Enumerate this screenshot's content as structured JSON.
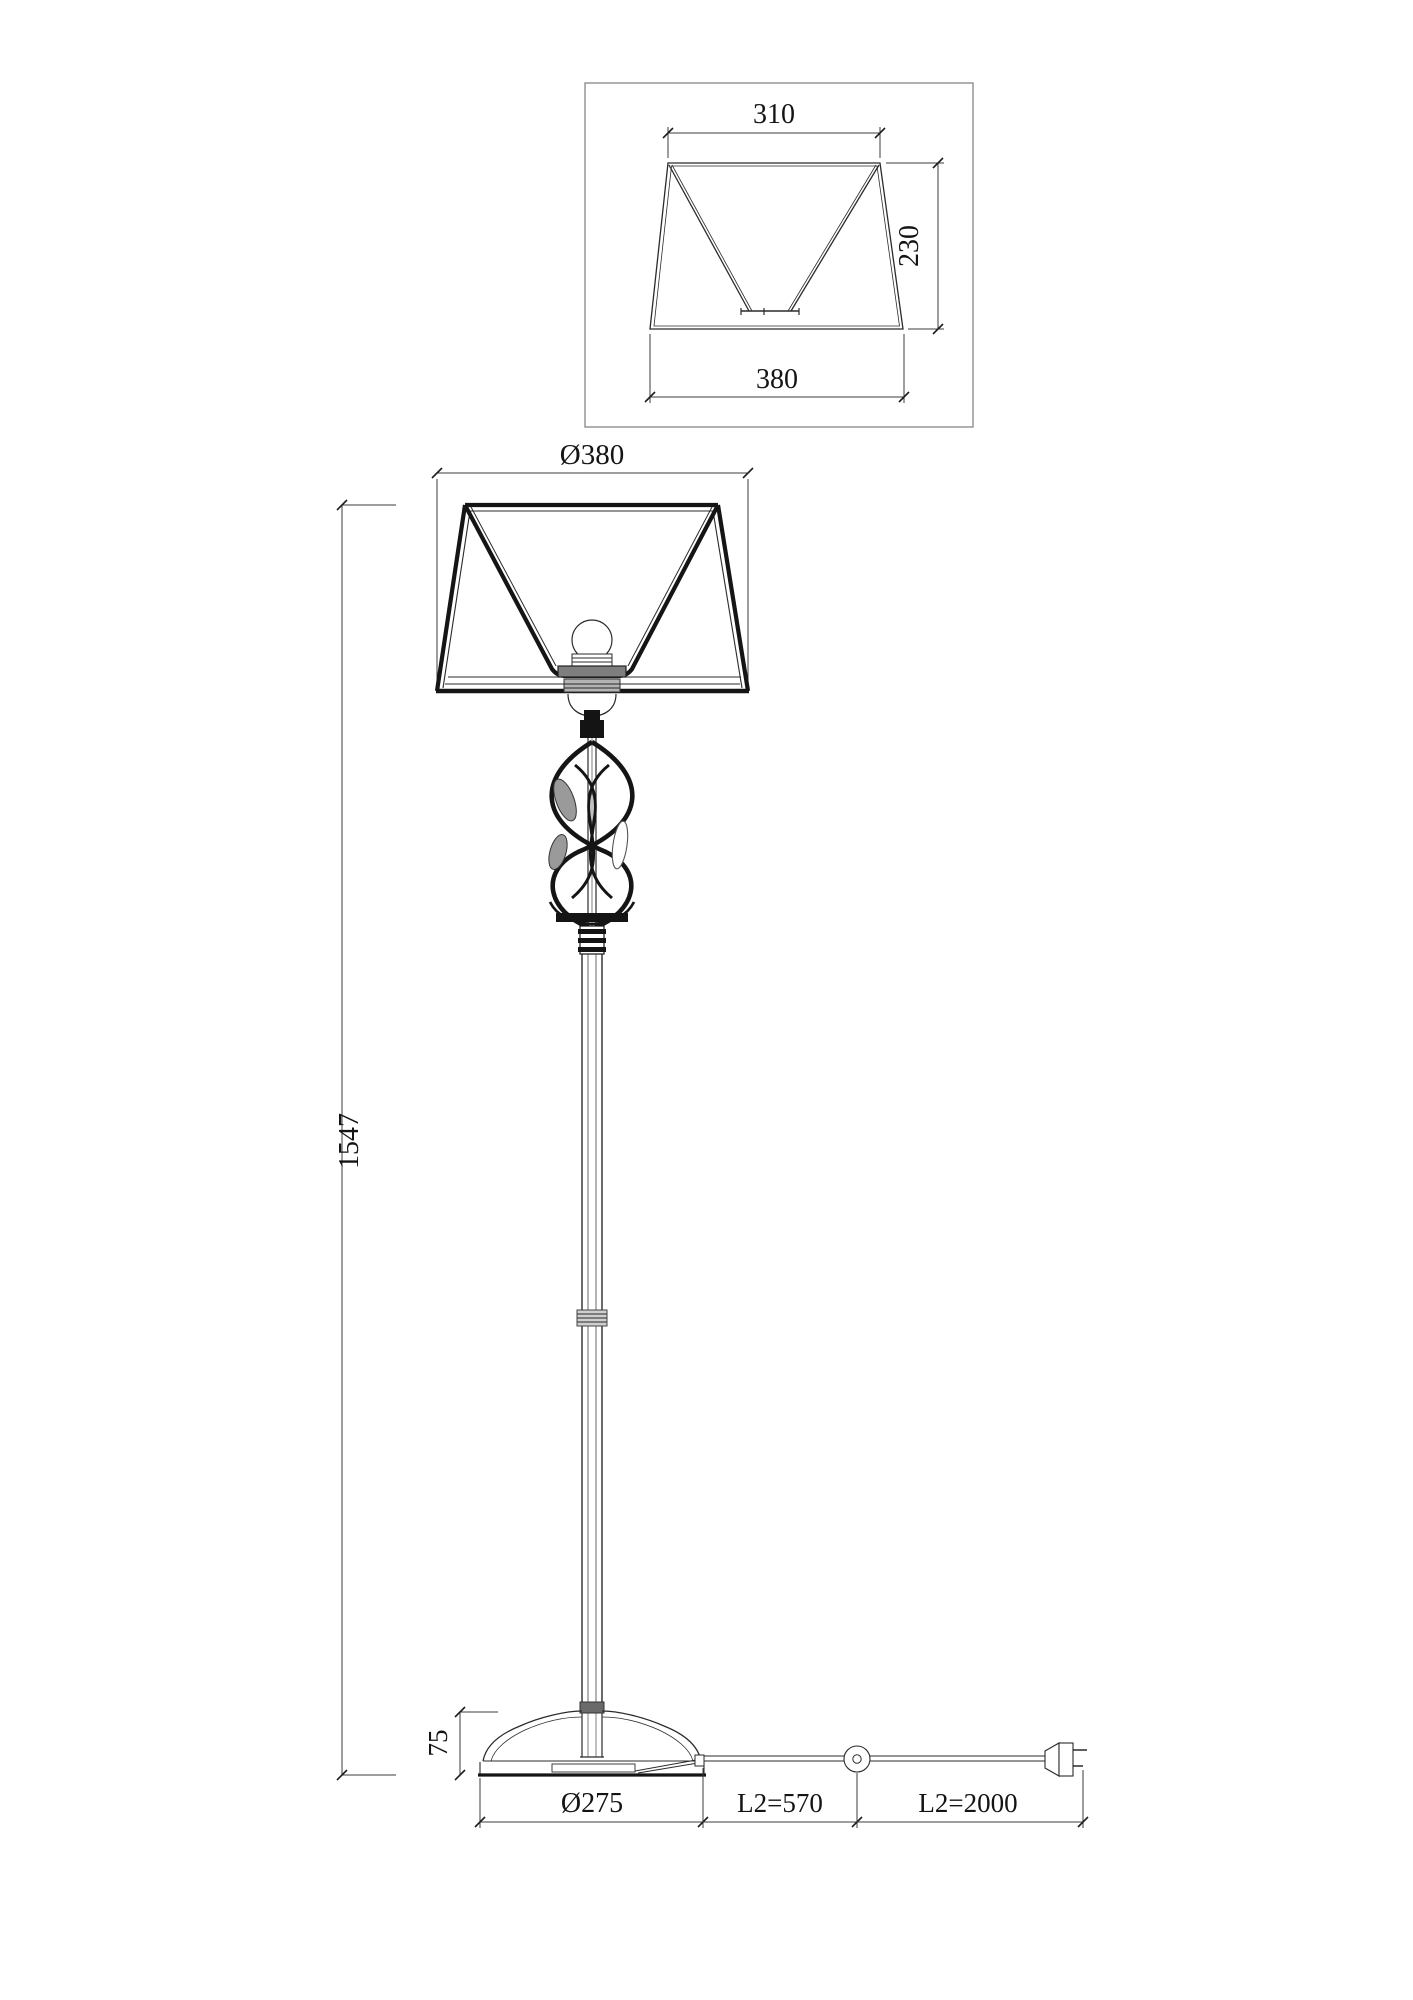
{
  "drawing": {
    "background": "#ffffff",
    "line_color": "#151515",
    "dimension_color": "#3c3c3c"
  },
  "detail_view": {
    "top_width_label": "310",
    "height_label": "230",
    "bottom_width_label": "380"
  },
  "front_view": {
    "shade_diameter_label": "Ø380",
    "total_height_label": "1547",
    "base_height_label": "75",
    "base_diameter_label": "Ø275",
    "cord_to_switch_label": "L2=570",
    "cord_to_plug_label": "L2=2000"
  }
}
